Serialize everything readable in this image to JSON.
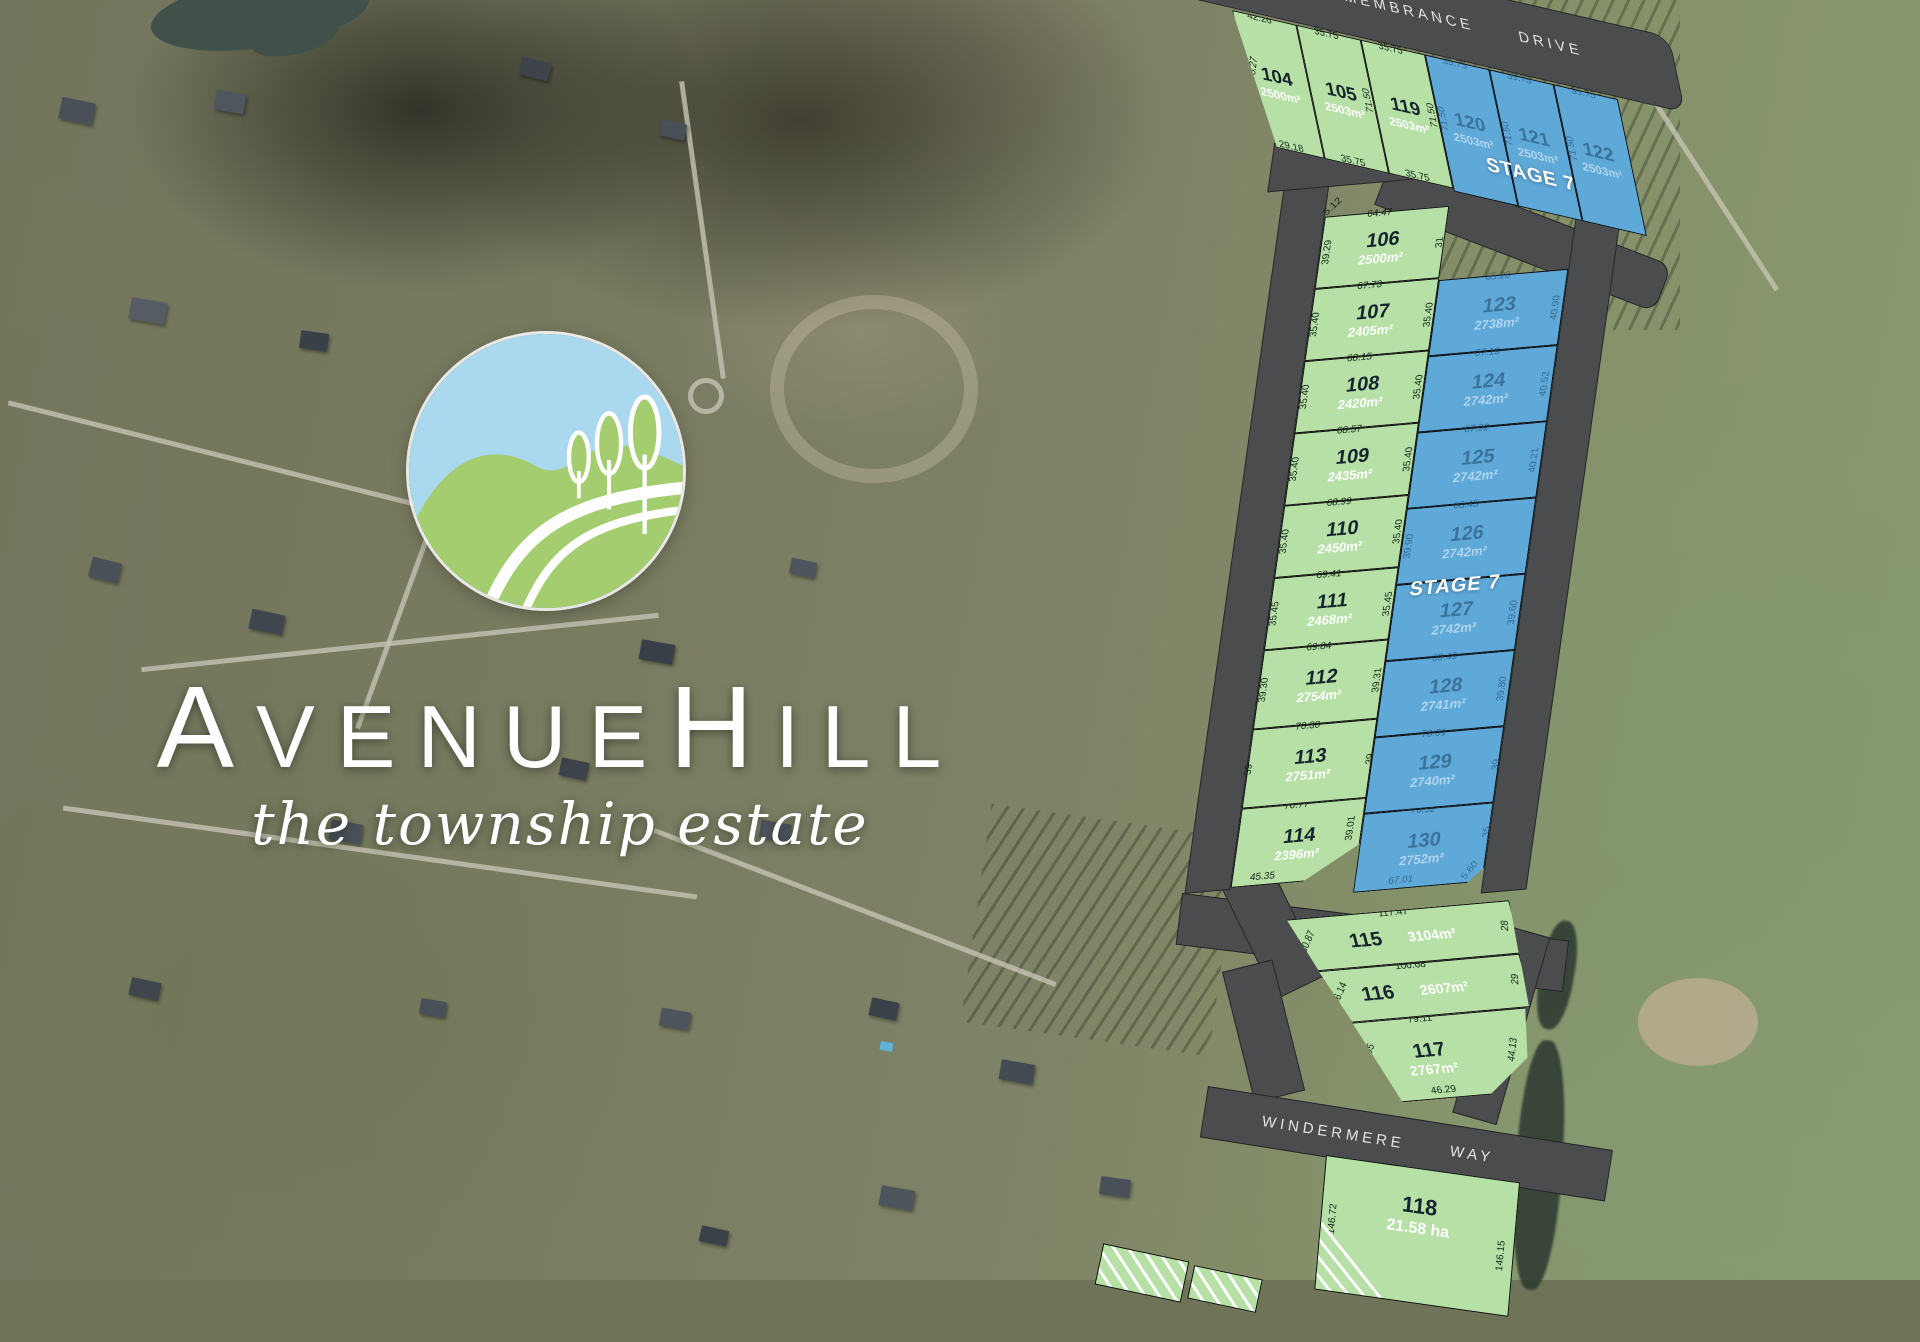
{
  "brand": {
    "i1": "A",
    "r1": "VENUE",
    "i2": "H",
    "r2": "ILL",
    "tagline": "the township estate"
  },
  "roads": {
    "remembrance_a": "REMEMBRANCE",
    "remembrance_b": "DRIVE",
    "windermere_a": "WINDERMERE",
    "windermere_b": "WAY"
  },
  "stage": {
    "top": "STAGE 7",
    "mid": "STAGE 7"
  },
  "colors": {
    "lot_green": "#b6e0a5",
    "lot_blue": "#5fa9d9",
    "road_gray": "#4b4c4e",
    "logo_sky": "#aad8ef",
    "logo_green": "#a3cd6e"
  },
  "lots": {
    "l104": {
      "num": "104",
      "area": "2500m²",
      "top": "42.26",
      "left": "75.27",
      "bottom": "29.18"
    },
    "l105": {
      "num": "105",
      "area": "2503m²",
      "top": "35.75",
      "right": "71.50",
      "bottom": "35.75"
    },
    "l119": {
      "num": "119",
      "area": "2503m²",
      "top": "35.75",
      "right": "71.50",
      "bottom": "35.75"
    },
    "l120": {
      "num": "120",
      "area": "2503m²",
      "top": "35.75",
      "side": "71.50"
    },
    "l121": {
      "num": "121",
      "area": "2503m²",
      "top": "35.75",
      "side": "71.50"
    },
    "l122": {
      "num": "122",
      "area": "2503m²",
      "top": "35.75",
      "side": "71.50"
    },
    "l106": {
      "num": "106",
      "area": "2500m²",
      "top": "64.47",
      "left": "39.29",
      "right": "31",
      "extra": "5.12"
    },
    "l107": {
      "num": "107",
      "area": "2405m²",
      "top": "67.73",
      "left": "35.40",
      "right": "35.40"
    },
    "l108": {
      "num": "108",
      "area": "2420m²",
      "top": "68.15",
      "left": "35.40",
      "right": "35.40"
    },
    "l109": {
      "num": "109",
      "area": "2435m²",
      "top": "68.57",
      "left": "35.40",
      "right": "35.40"
    },
    "l110": {
      "num": "110",
      "area": "2450m²",
      "top": "68.99",
      "left": "35.40",
      "right": "35.40"
    },
    "l111": {
      "num": "111",
      "area": "2468m²",
      "top": "69.41",
      "left": "35.45",
      "right": "35.45"
    },
    "l112": {
      "num": "112",
      "area": "2754m²",
      "top": "69.84",
      "left": "39.30",
      "right": "39.31"
    },
    "l113": {
      "num": "113",
      "area": "2751m²",
      "top": "70.30",
      "left": "39",
      "right": "39"
    },
    "l114": {
      "num": "114",
      "area": "2396m²",
      "top": "70.77",
      "right": "39.01",
      "bottom": "45.35"
    },
    "l123": {
      "num": "123",
      "area": "2738m²",
      "top": "65.20",
      "right": "40.90"
    },
    "l124": {
      "num": "124",
      "area": "2742m²",
      "top": "67.19",
      "right": "40.52"
    },
    "l125": {
      "num": "125",
      "area": "2742m²",
      "top": "67.92",
      "right": "40.21"
    },
    "l126": {
      "num": "126",
      "area": "2742m²",
      "top": "68.45",
      "left": "39.90"
    },
    "l127": {
      "num": "127",
      "area": "2742m²",
      "right": "39.60"
    },
    "l128": {
      "num": "128",
      "area": "2741m²",
      "top": "69.49",
      "right": "39.80"
    },
    "l129": {
      "num": "129",
      "area": "2740m²",
      "top": "70.01",
      "right": "39"
    },
    "l130": {
      "num": "130",
      "area": "2752m²",
      "top": "70.52",
      "bottom": "67.01",
      "right": "35",
      "corner": "5.60"
    },
    "l115": {
      "num": "115",
      "area": "3104m²",
      "top": "117.47",
      "left": "30.87",
      "right": "28"
    },
    "l116": {
      "num": "116",
      "area": "2607m²",
      "top": "100.68",
      "left": "36.14",
      "right": "29"
    },
    "l117": {
      "num": "117",
      "area": "2767m²",
      "top": "79.11",
      "left": "55",
      "right": "44.13",
      "bottom": "46.29"
    },
    "l118": {
      "num": "118",
      "area": "21.58 ha",
      "left": "146.72",
      "right": "146.15"
    }
  }
}
